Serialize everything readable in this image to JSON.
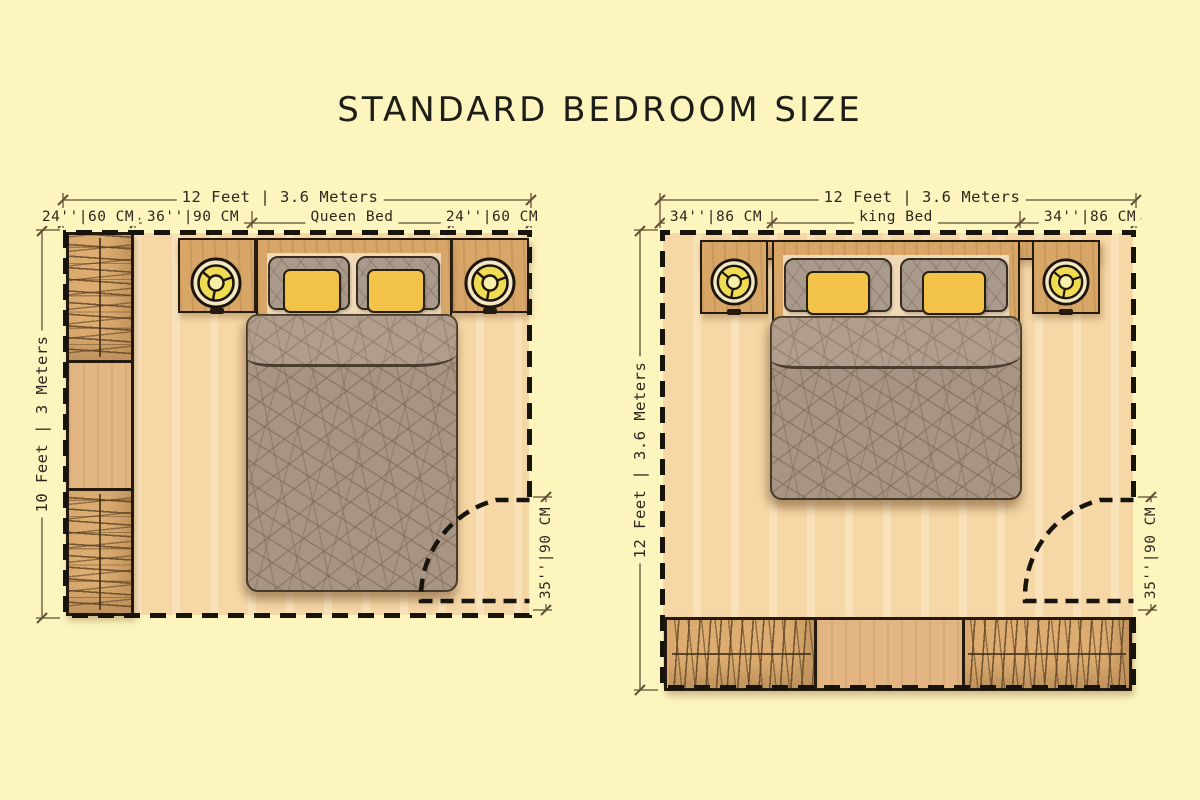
{
  "title": "STANDARD BEDROOM SIZE",
  "colors": {
    "background": "#FCF5BE",
    "floor": "#F6D7A6",
    "wood": "#D8A768",
    "walls": "#17130D",
    "duvet": "#A79482",
    "pillow_yellow": "#F3C349",
    "pillow_gray": "#A99A8B",
    "lamp_yellow": "#F0DC52",
    "dimension_line": "#7A684A",
    "text": "#2E281E"
  },
  "left_plan": {
    "dim_width": "12 Feet | 3.6 Meters",
    "dim_depth": "10 Feet | 3 Meters",
    "dim_door": "35''|90 CM",
    "dim_segments": [
      "24''|60 CM",
      "36''|90 CM",
      "Queen Bed",
      "24''|60 CM"
    ]
  },
  "right_plan": {
    "dim_width": "12 Feet | 3.6 Meters",
    "dim_depth": "12 Feet | 3.6 Meters",
    "dim_door": "35''|90 CM",
    "dim_segments": [
      "34''|86 CM",
      "king Bed",
      "34''|86 CM"
    ]
  }
}
